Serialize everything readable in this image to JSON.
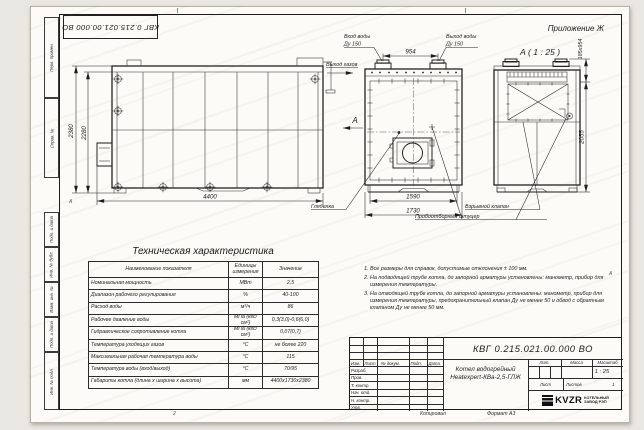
{
  "frame": {
    "doc_number_top": "КВГ 0.215.021.00.000 ВО",
    "appendix": "Приложение Ж",
    "zone_bottom": "2",
    "zone_left": "А",
    "zone_right": "А",
    "side_columns": [
      "Перв. примен.",
      "Справ. №",
      "Подп. и дата",
      "Инв. № дубл.",
      "Взам. инв. №",
      "Подп. и дата",
      "Инв. № подл."
    ]
  },
  "views": {
    "side": {
      "dim_outer_height": "2380",
      "dim_inner_height": "2280",
      "dim_length": "4400"
    },
    "front": {
      "water_in_1": "Вход воды",
      "water_in_2": "Ду 150",
      "water_out_1": "Выход воды",
      "water_out_2": "Ду 150",
      "gas_out": "Выход газов",
      "dim_flange_span": "954",
      "section_letter": "А",
      "dim_inner_width": "1590",
      "dim_outer_width": "1730",
      "sight_glass": "Гляделка"
    },
    "rear": {
      "title": "А ( 1 : 25 )",
      "dim_top": "185х954",
      "dim_height": "2055",
      "explosion_valve": "Взрывной клапан",
      "sampling_fitting": "Пробоотборный штуцер"
    }
  },
  "tech_table": {
    "title": "Техническая характеристика",
    "headers": [
      "Наименование показателя",
      "Единицы измерения",
      "Значение"
    ],
    "rows": [
      [
        "Номинальная мощность",
        "МВт",
        "2,5"
      ],
      [
        "Диапазон рабочего регулирования",
        "%",
        "40-100"
      ],
      [
        "Расход воды",
        "м³/ч",
        "86"
      ],
      [
        "Рабочее давление воды",
        "МПа (кгс/см²)",
        "0,3(3,0)-0,6(6,0)"
      ],
      [
        "Гидравлическое сопротивление котла",
        "МПа (кгс/см²)",
        "0,07(0,7)"
      ],
      [
        "Температура уходящих газов",
        "°С",
        "не более 220"
      ],
      [
        "Максимальная рабочая температура воды",
        "°С",
        "115"
      ],
      [
        "Температура воды (вход/выход)",
        "°С",
        "70/95"
      ],
      [
        "Габариты котла (длина х ширина х высота)",
        "мм",
        "4400х1730х2380"
      ]
    ]
  },
  "notes": [
    "Все размеры для справок, допустимые отклонения ± 100 мм.",
    "На подводящей трубе котла, до запорной арматуры установлены: манометр, прибор для измерения температуры.",
    "На отводящей трубе котла, до запорной арматуры установлены: манометр, прибор для измерения температуры, предохранительный клапан Ду не менее 50 и обвод с обратным клапаном Ду не менее 50 мм."
  ],
  "title_block": {
    "doc_number": "КВГ 0.215.021.00.000 ВО",
    "product_name_1": "Котел водогрейный",
    "product_name_2": "Heatexpert-КВа-2,5-ГЛЖ",
    "cols": [
      "Изм.",
      "Лист",
      "№ докум.",
      "Подп.",
      "Дата"
    ],
    "rows": [
      "Разраб.",
      "Пров.",
      "Т. контр.",
      "Нач. отд.",
      "Н. контр.",
      "Утв."
    ],
    "lit": "Лит.",
    "mass": "Масса",
    "scale": "Масштаб",
    "scale_value": "1 : 25",
    "sheet": "Лист",
    "sheets": "Листов",
    "sheets_value": "1",
    "logo_text": "KVZR",
    "company_1": "КОТЕЛЬНЫЙ",
    "company_2": "ЗАВОД РЭП",
    "copied": "Копировал",
    "format": "Формат А3"
  }
}
